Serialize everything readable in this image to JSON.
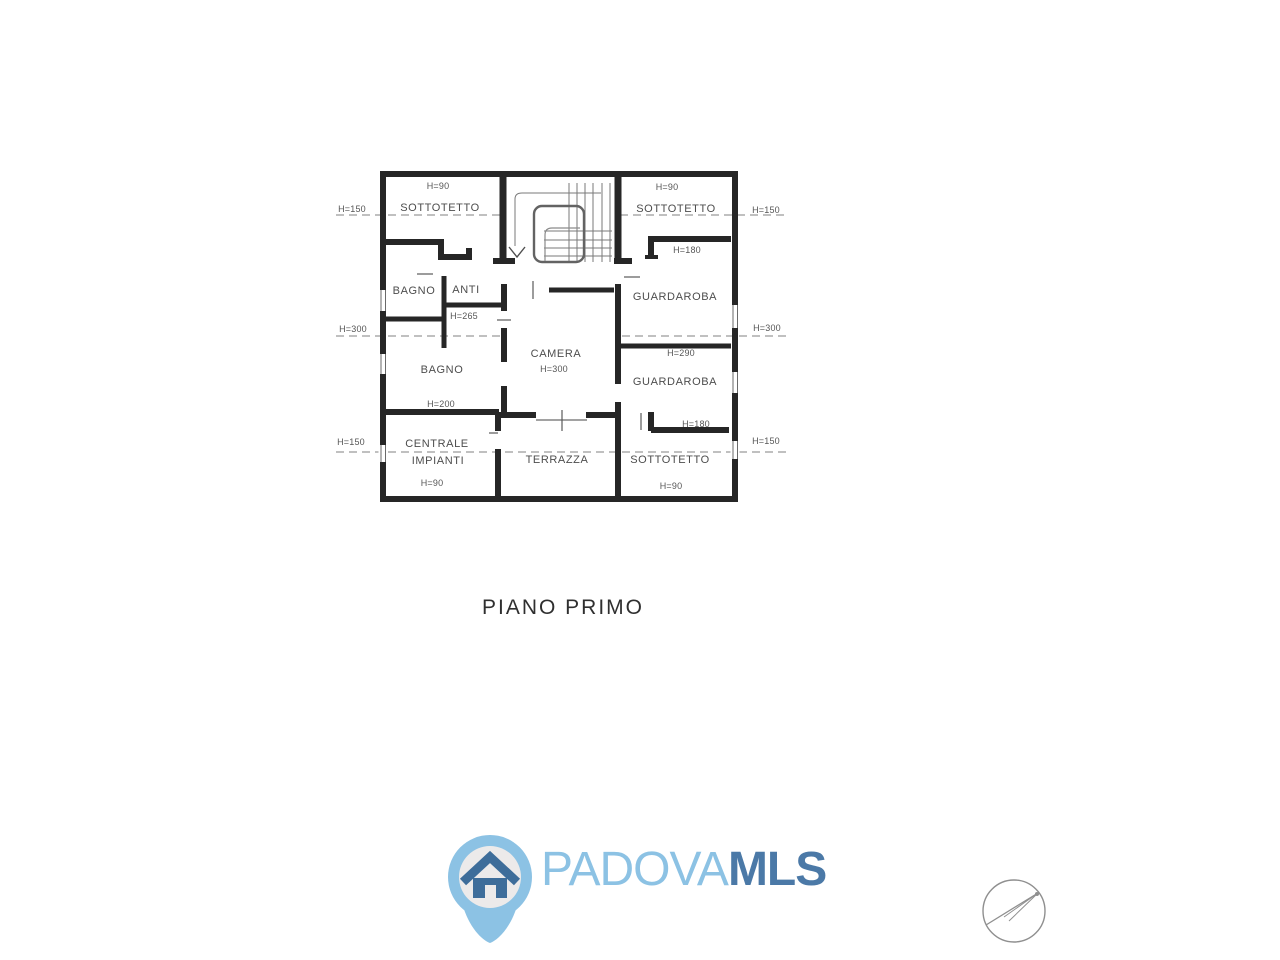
{
  "floor_plan": {
    "title": "PIANO PRIMO",
    "section_markers": {
      "left": [
        "H=150",
        "H=300",
        "H=150"
      ],
      "right": [
        "H=150",
        "H=300",
        "H=150"
      ]
    },
    "rooms": {
      "sottotetto_top_left": {
        "name": "SOTTOTETTO",
        "height": "H=90"
      },
      "sottotetto_top_right": {
        "name": "SOTTOTETTO",
        "height": "H=90"
      },
      "bagno_top": {
        "name": "BAGNO"
      },
      "anti": {
        "name": "ANTI"
      },
      "bagno_bottom": {
        "name": "BAGNO"
      },
      "camera": {
        "name": "CAMERA",
        "height": "H=300"
      },
      "guardaroba_top": {
        "name": "GUARDAROBA",
        "wall_height": "H=180"
      },
      "guardaroba_bottom": {
        "name": "GUARDAROBA",
        "wall_height": "H=290"
      },
      "centrale_impianti": {
        "name_line_1": "CENTRALE",
        "name_line_2": "IMPIANTI",
        "height": "H=90"
      },
      "terrazza": {
        "name": "TERRAZZA"
      },
      "sottotetto_bottom_right": {
        "name": "SOTTOTETTO",
        "height": "H=90",
        "wall_height": "H=180"
      }
    },
    "wall_labels": {
      "h265": "H=265",
      "h200": "H=200"
    }
  },
  "branding": {
    "logo_text_light": "PADOVA",
    "logo_text_bold": "MLS",
    "colors": {
      "logo_light_blue": "#8cc2e4",
      "logo_dark_blue": "#4b79a7",
      "pin_house_blue": "#3e6d9a",
      "pin_inner_gray": "#eceaea"
    }
  },
  "drawing": {
    "wall_color": "#262626",
    "dashed_line_color": "#9b9b9b",
    "label_color": "#4d4d4d"
  },
  "icons": {
    "logo_pin": "map-pin-house-icon",
    "compass": "north-arrow-compass-icon"
  }
}
